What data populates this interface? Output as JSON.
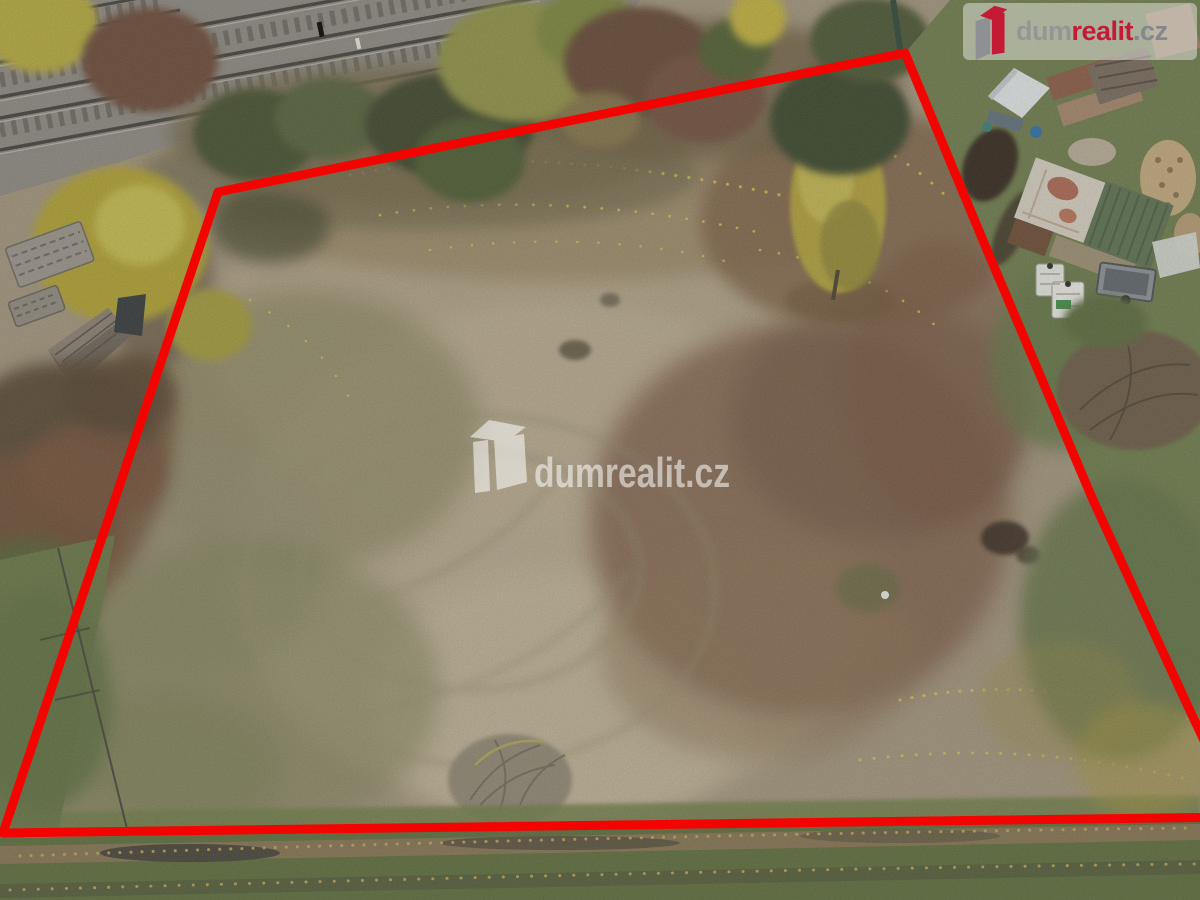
{
  "branding": {
    "watermark_text": "dumrealit.cz",
    "logo": {
      "dum": "dum",
      "realit": "realit",
      "cz": ".cz"
    }
  },
  "colors": {
    "boundary_red": "#f20500",
    "brand_red": "#c41a35",
    "brand_gray": "#8d9094",
    "fence_green": "#2f4538",
    "field_tan": "#a79a81",
    "reddish_patch": "#7b5c46",
    "grass_green": "#65744a",
    "railway_gray": "#8d8882",
    "foliage_yellow": "#b3a33b"
  },
  "scene": {
    "plot_boundary_points": "218,192 905,53 987,250 1093,500 1185,700 1240,817 3,833"
  }
}
